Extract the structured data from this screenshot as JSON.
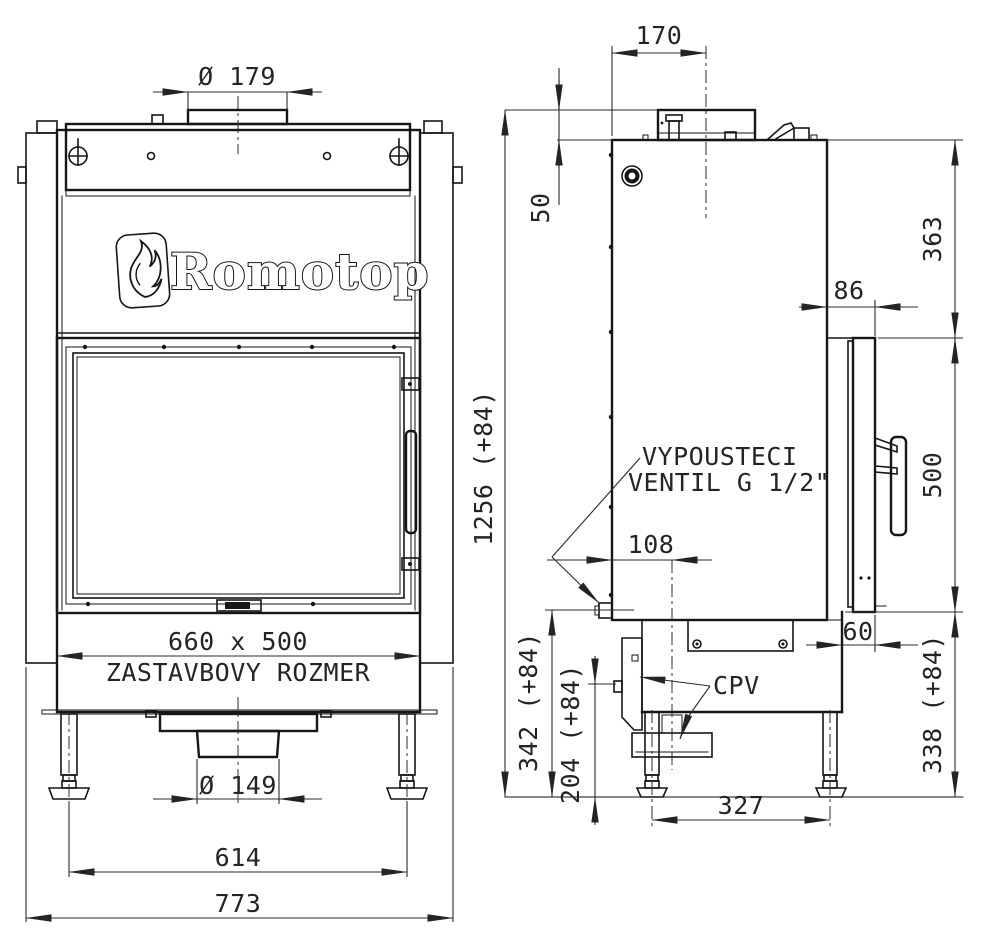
{
  "brand": {
    "logo_text": "Romotop"
  },
  "front_view": {
    "dims": {
      "flue_diameter": "Ø 179",
      "opening_size": "660 x 500",
      "opening_label": "ZASTAVBOVY ROZMER",
      "outlet_diameter": "Ø 149",
      "feet_spacing": "614",
      "overall_width": "773"
    }
  },
  "side_view": {
    "dims": {
      "flue_center_offset": "170",
      "collar_height": "50",
      "overall_height": "1256 (+84)",
      "top_to_door": "363",
      "door_height": "500",
      "door_depth_offset": "86",
      "valve_offset": "108",
      "bottom_step_depth": "60",
      "valve_height": "342 (+84)",
      "cpv_height": "204 (+84)",
      "base_height": "338 (+84)",
      "feet_spacing": "327"
    },
    "labels": {
      "drain_valve_line1": "VYPOUSTECI",
      "drain_valve_line2": "VENTIL G 1/2\"",
      "cpv": "CPV"
    }
  },
  "colors": {
    "line": "#161616",
    "background": "#ffffff"
  }
}
